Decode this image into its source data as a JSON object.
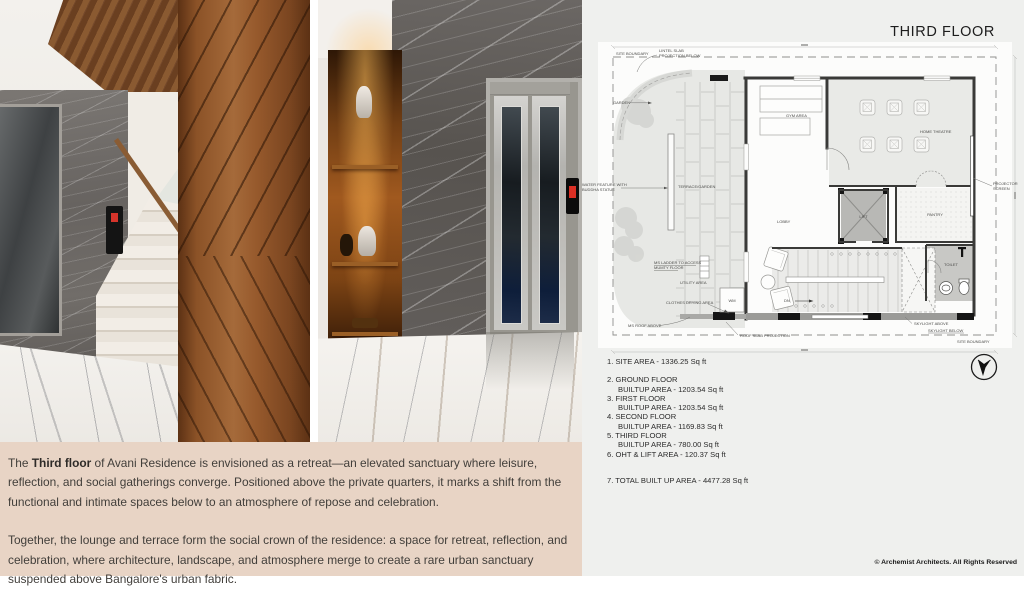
{
  "header": {
    "title": "THIRD FLOOR"
  },
  "caption": {
    "p1_prefix": "The ",
    "p1_bold": "Third floor",
    "p1_rest": " of Avani Residence is envisioned as a retreat—an elevated sanctuary where leisure, reflection, and social gatherings converge. Positioned above the private quarters, it marks a shift from the functional and intimate spaces below to an atmosphere of repose and celebration.",
    "p2": "Together, the lounge and terrace form the social crown of the residence: a space for retreat, reflection, and celebration, where architecture, landscape, and atmosphere merge to create a rare urban sanctuary suspended above Bangalore's urban fabric."
  },
  "plan": {
    "boundary_top": "SITE BOUNDARY",
    "boundary_bottom": "SITE BOUNDARY",
    "lintel_1": "LINTEL SLAB",
    "lintel_2": "PROJECTION BELOW",
    "garden": "GARDEN",
    "terrace_garden": "TERRACE/GARDEN",
    "water_feature_1": "WATER FEATURE WITH",
    "water_feature_2": "BUDDHA STATUE",
    "ms_ladder_1": "MS LADDER TO ACCESS",
    "ms_ladder_2": "MUMTY FLOOR",
    "utility": "UTILITY AREA",
    "clothes": "CLOTHES DRYING AREA",
    "wm": "WM",
    "ms_roof": "MS ROOF ABOVE",
    "roof_slab": "ROOF SLAB PROJECTION",
    "gym": "GYM AREA",
    "home_theatre": "HOME THEATRE",
    "projector_1": "PROJECTOR",
    "projector_2": "SCREEN",
    "lobby": "LOBBY",
    "lift": "LIFT",
    "pantry": "PANTRY",
    "toilet": "TOILET",
    "dn": "DN",
    "skylight_above": "SKYLIGHT ABOVE",
    "skylight_below": "SKYLIGHT BELOW"
  },
  "areas": {
    "items": [
      {
        "title": "1. SITE AREA -  1336.25 Sq ft",
        "sub": ""
      },
      {
        "title": "2. GROUND FLOOR",
        "sub": "BUILTUP AREA - 1203.54 Sq ft"
      },
      {
        "title": "3. FIRST FLOOR",
        "sub": "BUILTUP AREA - 1203.54 Sq ft"
      },
      {
        "title": "4. SECOND FLOOR",
        "sub": "BUILTUP AREA - 1169.83 Sq ft"
      },
      {
        "title": "5. THIRD FLOOR",
        "sub": "BUILTUP AREA - 780.00 Sq ft"
      },
      {
        "title": "6. OHT & LIFT AREA - 120.37 Sq ft",
        "sub": ""
      },
      {
        "title": "7. TOTAL BUILT UP AREA -  4477.28 Sq ft",
        "sub": ""
      }
    ]
  },
  "footer": {
    "copyright": "© Archemist Architects. All Rights Reserved"
  },
  "colors": {
    "beige": "#e8d4c5",
    "panel_gray": "#eff0ee",
    "indicator_red": "#da2f24"
  }
}
